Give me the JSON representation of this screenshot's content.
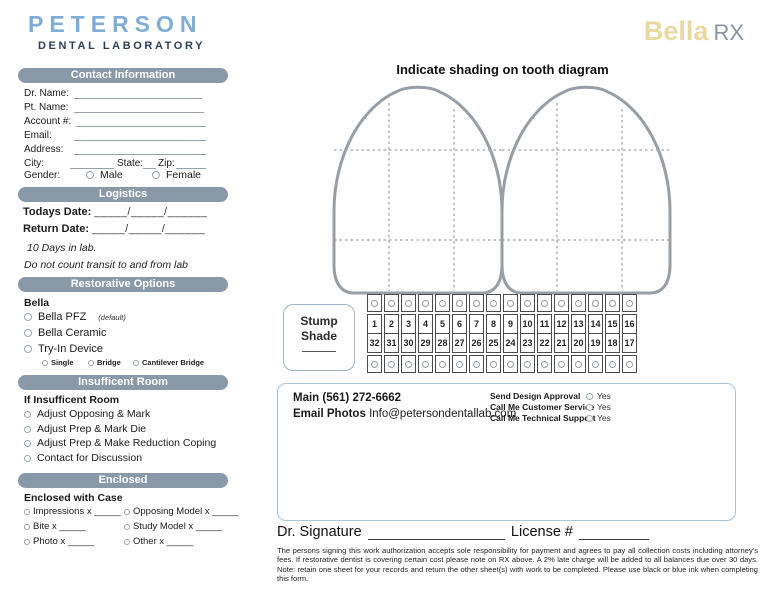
{
  "brand": {
    "logo_title": "PETERSON",
    "logo_subtitle": "DENTAL LABORATORY",
    "product": "Bella",
    "product_suffix": "RX"
  },
  "contact_info": {
    "header": "Contact Information",
    "fields": [
      {
        "label": "Dr. Name:"
      },
      {
        "label": "Pt. Name:"
      },
      {
        "label": "Account #:"
      },
      {
        "label": "Email:"
      },
      {
        "label": "Address:"
      }
    ],
    "city_label": "City:",
    "state_label": "State:",
    "zip_label": "Zip:",
    "gender_label": "Gender:",
    "gender_options": [
      "Male",
      "Female"
    ]
  },
  "logistics": {
    "header": "Logistics",
    "todays_date_label": "Todays Date:",
    "todays_date_value": "_____/_____/______",
    "return_date_label": "Return Date:",
    "return_date_value": "_____/_____/______",
    "note1": "10 Days in lab.",
    "note2": "Do not count transit to and from lab"
  },
  "restorative": {
    "header": "Restorative Options",
    "group_label": "Bella",
    "options": [
      "Bella PFZ",
      "Bella Ceramic",
      "Try-In Device"
    ],
    "default_note": "(default)",
    "sub_options": [
      "Single",
      "Bridge",
      "Cantilever Bridge"
    ]
  },
  "insufficient_room": {
    "header": "Insufficent Room",
    "group_label": "If Insufficent Room",
    "options": [
      "Adjust Opposing & Mark",
      "Adjust Prep & Mark Die",
      "Adjust Prep & Make Reduction Coping",
      "Contact for Discussion"
    ]
  },
  "enclosed": {
    "header": "Enclosed",
    "group_label": "Enclosed with Case",
    "left_options": [
      "Impressions x _____",
      "Bite x _____",
      "Photo x _____"
    ],
    "right_options": [
      "Opposing Model x _____",
      "Study Model x _____",
      "Other x _____"
    ]
  },
  "diagram": {
    "title": "Indicate shading on tooth diagram"
  },
  "stump_shade": {
    "line1": "Stump",
    "line2": "Shade"
  },
  "tooth_chart": {
    "upper": [
      1,
      2,
      3,
      4,
      5,
      6,
      7,
      8,
      9,
      10,
      11,
      12,
      13,
      14,
      15,
      16
    ],
    "lower": [
      32,
      31,
      30,
      29,
      28,
      27,
      26,
      25,
      24,
      23,
      22,
      21,
      20,
      19,
      18,
      17
    ]
  },
  "notes_box": {
    "phone_label": "Main",
    "phone": "(561) 272-6662",
    "email_label": "Email Photos",
    "email": "Info@petersondentallab.com",
    "approvals": [
      "Send Design Approval",
      "Call Me Customer Service",
      "Call Me Technical Support"
    ],
    "yes_label": "Yes"
  },
  "signature": {
    "dr_label": "Dr. Signature",
    "license_label": "License #"
  },
  "legal_text": "The persons signing this work authorization accepts sole responsibility for payment and agrees to pay all collection costs including attorney's fees. If restorative dentist is covering certain cost please note on RX above. A 2% late charge will be added to all balances due over 30 days. Note: retain one sheet  for your records and return the other sheet(s) with work to be completed. Please use black or blue ink when completing this form.",
  "colors": {
    "section_bar": "#8A99A8",
    "logo_blue": "#7FADD6",
    "logo_navy": "#2E3F58",
    "bella_gold": "#E9D9A1",
    "rx_gray": "#8A95A1",
    "box_border_blue": "#A9C6DC",
    "tooth_outline": "#979EA6"
  }
}
